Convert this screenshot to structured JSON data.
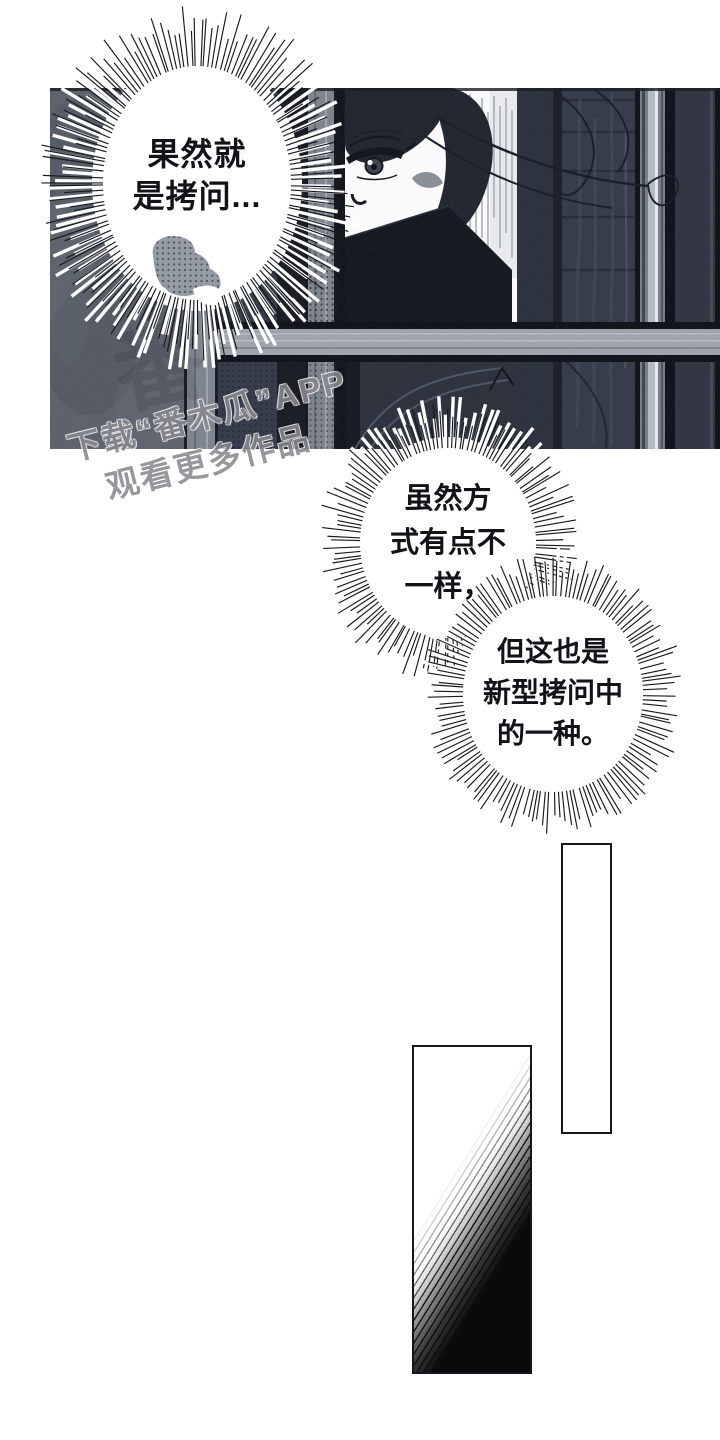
{
  "bubbles": [
    {
      "name": "bubble-1",
      "lines": [
        "果然就",
        "是拷问..."
      ]
    },
    {
      "name": "bubble-2",
      "lines": [
        "虽然方",
        "式有点不",
        "一样，"
      ]
    },
    {
      "name": "bubble-3",
      "lines": [
        "但这也是",
        "新型拷问中",
        "的一种。"
      ]
    }
  ],
  "watermark": {
    "line1": "下载“番木瓜”APP",
    "line2": "观看更多作品",
    "faint_glyph": "番"
  },
  "colors": {
    "page_bg": "#ffffff",
    "panel_bg": "#303644",
    "wall": "#585d68",
    "post_gray": "#7b818b",
    "bar_black": "#0c0f15",
    "beam_gray": "#9ca1a9",
    "hair": "#1b202a",
    "mask_dark": "#0e1219",
    "face_white": "#fbfbfc",
    "clothing": "#272c37",
    "bubble_text": "#121318",
    "watermark_gray": "#87898e",
    "ink": "#15171c"
  }
}
